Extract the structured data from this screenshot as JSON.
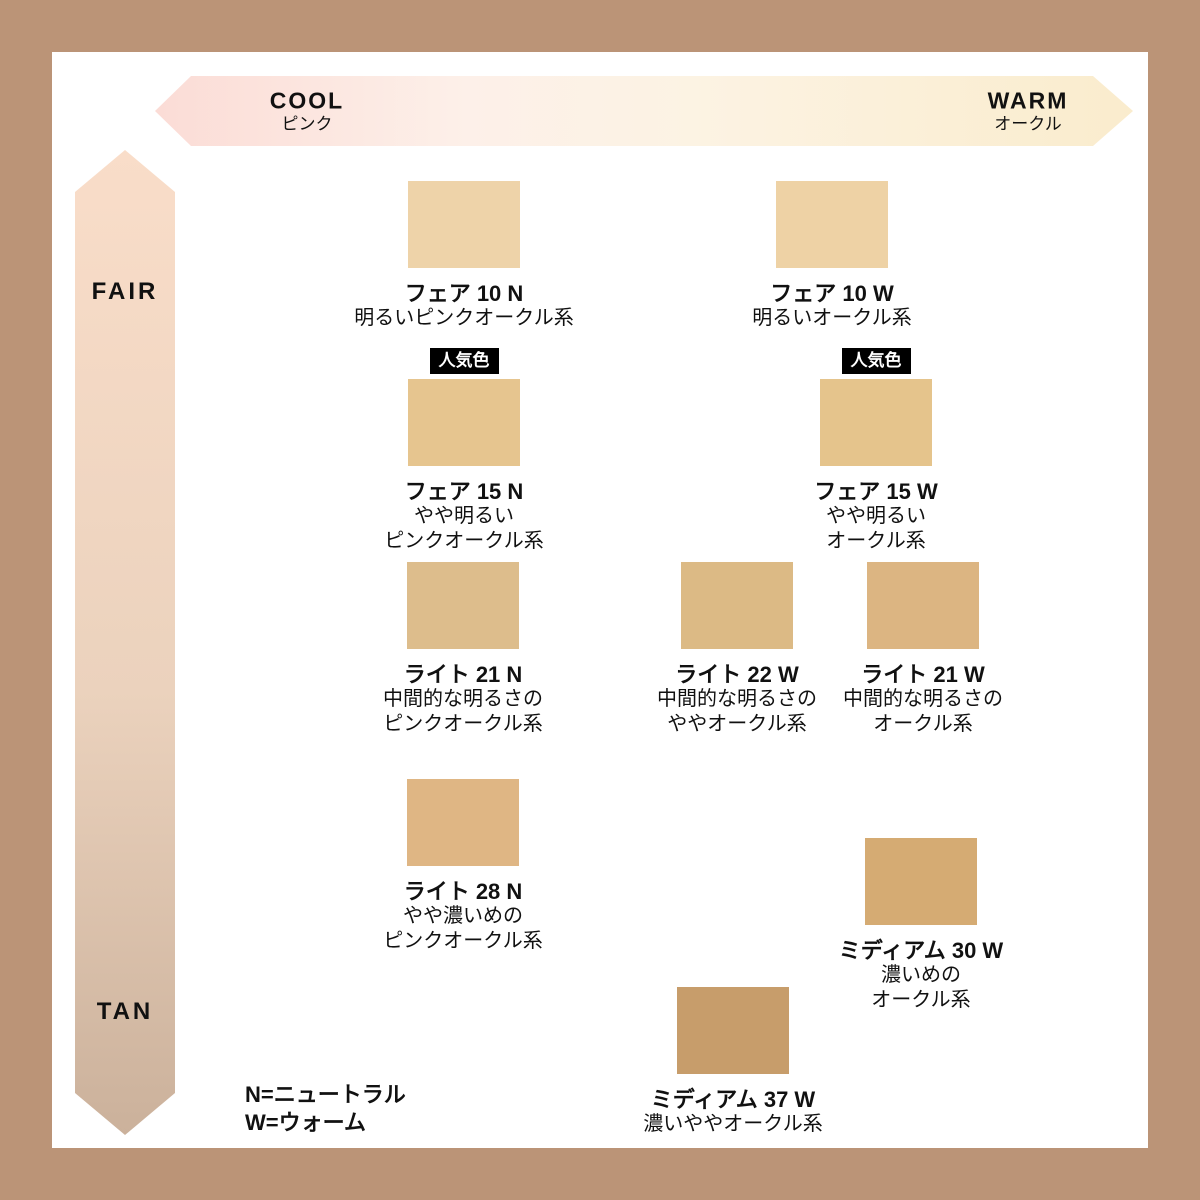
{
  "frame_color": "#bb9477",
  "axes": {
    "horizontal": {
      "left_label": "COOL",
      "left_sublabel": "ピンク",
      "right_label": "WARM",
      "right_sublabel": "オークル",
      "gradient": [
        "#fbdcd6 0%",
        "#fdf0e9 32%",
        "#fcf3e3 55%",
        "#faeccd 100%"
      ]
    },
    "vertical": {
      "top_label": "FAIR",
      "bottom_label": "TAN",
      "gradient": [
        "#f9ddc9 0%",
        "#ebd2bd 55%",
        "#cbb19b 100%"
      ]
    }
  },
  "badge_label": "人気色",
  "swatches": [
    {
      "name": "フェア 10 N",
      "line1": "明るいピンクオークル系",
      "color": "#eed3a9",
      "popular": false
    },
    {
      "name": "フェア 10 W",
      "line1": "明るいオークル系",
      "color": "#eed2a5",
      "popular": false
    },
    {
      "name": "フェア 15 N",
      "line1": "やや明るい",
      "line2": "ピンクオークル系",
      "color": "#e6c58f",
      "popular": true
    },
    {
      "name": "フェア 15 W",
      "line1": "やや明るい",
      "line2": "オークル系",
      "color": "#e5c48c",
      "popular": true
    },
    {
      "name": "ライト 21 N",
      "line1": "中間的な明るさの",
      "line2": "ピンクオークル系",
      "color": "#ddbd8c",
      "popular": false
    },
    {
      "name": "ライト 22 W",
      "line1": "中間的な明るさの",
      "line2": "ややオークル系",
      "color": "#dcba85",
      "popular": false
    },
    {
      "name": "ライト 21 W",
      "line1": "中間的な明るさの",
      "line2": "オークル系",
      "color": "#dcb582",
      "popular": false
    },
    {
      "name": "ライト 28 N",
      "line1": "やや濃いめの",
      "line2": "ピンクオークル系",
      "color": "#dfb684",
      "popular": false
    },
    {
      "name": "ミディアム 30 W",
      "line1": "濃いめの",
      "line2": "オークル系",
      "color": "#d5ab73",
      "popular": false
    },
    {
      "name": "ミディアム 37 W",
      "line1": "濃いややオークル系",
      "color": "#c79d6b",
      "popular": false
    }
  ],
  "legend": {
    "line1": "N=ニュートラル",
    "line2": "W=ウォーム"
  }
}
